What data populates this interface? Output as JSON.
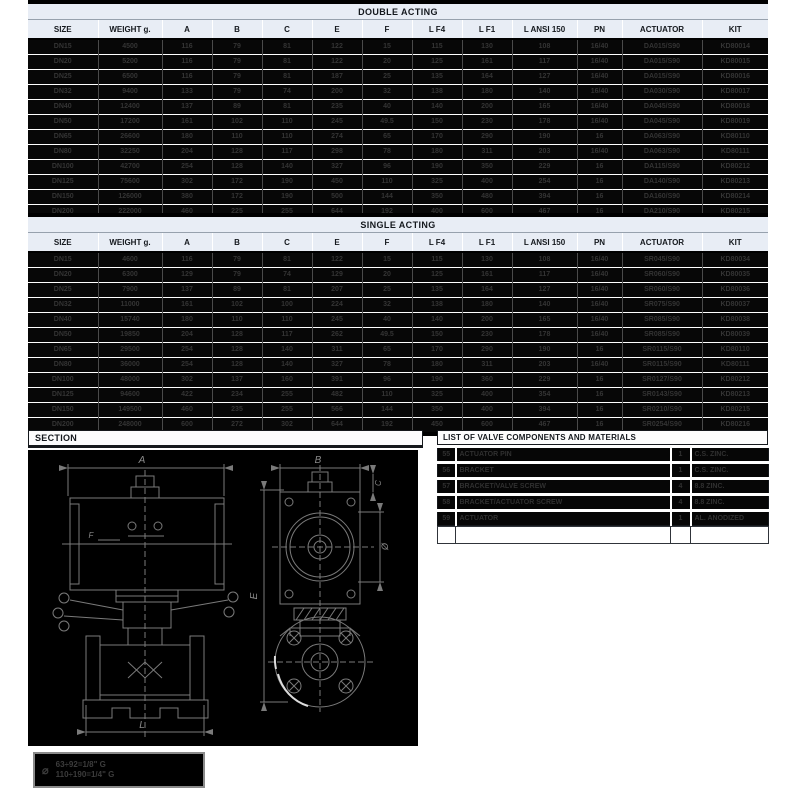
{
  "tables": {
    "columns": [
      "SIZE",
      "WEIGHT g.",
      "A",
      "B",
      "C",
      "E",
      "F",
      "L F4",
      "L F1",
      "L ANSI 150",
      "PN",
      "ACTUATOR",
      "KIT"
    ],
    "double_acting": {
      "title": "DOUBLE ACTING",
      "rows": [
        [
          "DN15",
          "4500",
          "116",
          "79",
          "81",
          "122",
          "15",
          "115",
          "130",
          "108",
          "16/40",
          "DA015/S90",
          "KD80014"
        ],
        [
          "DN20",
          "5200",
          "116",
          "79",
          "81",
          "122",
          "20",
          "125",
          "161",
          "117",
          "16/40",
          "DA015/S90",
          "KD80015"
        ],
        [
          "DN25",
          "6500",
          "116",
          "79",
          "81",
          "187",
          "25",
          "135",
          "164",
          "127",
          "16/40",
          "DA015/S90",
          "KD80016"
        ],
        [
          "DN32",
          "9400",
          "133",
          "79",
          "74",
          "200",
          "32",
          "138",
          "180",
          "140",
          "16/40",
          "DA030/S90",
          "KD80017"
        ],
        [
          "DN40",
          "12400",
          "137",
          "89",
          "81",
          "235",
          "40",
          "140",
          "200",
          "165",
          "16/40",
          "DA045/S90",
          "KD80018"
        ],
        [
          "DN50",
          "17200",
          "161",
          "102",
          "110",
          "245",
          "49.5",
          "150",
          "230",
          "178",
          "16/40",
          "DA045/S90",
          "KD80019"
        ],
        [
          "DN65",
          "26600",
          "180",
          "110",
          "110",
          "274",
          "65",
          "170",
          "290",
          "190",
          "16",
          "DA063/S90",
          "KD80110"
        ],
        [
          "DN80",
          "32250",
          "204",
          "128",
          "117",
          "298",
          "78",
          "180",
          "311",
          "203",
          "16/40",
          "DA063/S90",
          "KD80111"
        ],
        [
          "DN100",
          "42700",
          "254",
          "128",
          "140",
          "327",
          "96",
          "190",
          "350",
          "229",
          "16",
          "DA115/S90",
          "KD80212"
        ],
        [
          "DN125",
          "75600",
          "302",
          "172",
          "190",
          "450",
          "110",
          "325",
          "400",
          "254",
          "16",
          "DA140/S90",
          "KD80213"
        ],
        [
          "DN150",
          "126000",
          "380",
          "172",
          "190",
          "500",
          "144",
          "350",
          "480",
          "394",
          "16",
          "DA160/S90",
          "KD80214"
        ],
        [
          "DN200",
          "222000",
          "460",
          "225",
          "255",
          "644",
          "192",
          "400",
          "600",
          "467",
          "16",
          "DA210/S90",
          "KD80215"
        ]
      ]
    },
    "single_acting": {
      "title": "SINGLE ACTING",
      "rows": [
        [
          "DN15",
          "4600",
          "116",
          "79",
          "81",
          "122",
          "15",
          "115",
          "130",
          "108",
          "16/40",
          "SR045/S90",
          "KD80034"
        ],
        [
          "DN20",
          "6300",
          "129",
          "79",
          "74",
          "129",
          "20",
          "125",
          "161",
          "117",
          "16/40",
          "SR060/S90",
          "KD80035"
        ],
        [
          "DN25",
          "7900",
          "137",
          "89",
          "81",
          "207",
          "25",
          "135",
          "164",
          "127",
          "16/40",
          "SR060/S90",
          "KD80036"
        ],
        [
          "DN32",
          "11000",
          "161",
          "102",
          "100",
          "224",
          "32",
          "138",
          "180",
          "140",
          "16/40",
          "SR075/S90",
          "KD80037"
        ],
        [
          "DN40",
          "15740",
          "180",
          "110",
          "110",
          "245",
          "40",
          "140",
          "200",
          "165",
          "16/40",
          "SR085/S90",
          "KD80038"
        ],
        [
          "DN50",
          "19850",
          "204",
          "128",
          "117",
          "262",
          "49.5",
          "150",
          "230",
          "178",
          "16/40",
          "SR085/S90",
          "KD80039"
        ],
        [
          "DN65",
          "29500",
          "254",
          "128",
          "140",
          "311",
          "65",
          "170",
          "290",
          "190",
          "16",
          "SR0115/S90",
          "KD80110"
        ],
        [
          "DN80",
          "36000",
          "254",
          "128",
          "140",
          "327",
          "78",
          "180",
          "311",
          "203",
          "16/40",
          "SR0115/S90",
          "KD80111"
        ],
        [
          "DN100",
          "48000",
          "302",
          "137",
          "160",
          "391",
          "96",
          "190",
          "360",
          "229",
          "16",
          "SR0127/S90",
          "KD80212"
        ],
        [
          "DN125",
          "94600",
          "422",
          "234",
          "255",
          "482",
          "110",
          "325",
          "400",
          "354",
          "16",
          "SR0143/S90",
          "KD80213"
        ],
        [
          "DN150",
          "149500",
          "460",
          "235",
          "255",
          "566",
          "144",
          "350",
          "400",
          "394",
          "16",
          "SR0210/S90",
          "KD80215"
        ],
        [
          "DN200",
          "248000",
          "600",
          "272",
          "302",
          "644",
          "192",
          "450",
          "600",
          "467",
          "16",
          "SR0254/S90",
          "KD80216"
        ]
      ]
    }
  },
  "section": {
    "title": "SECTION",
    "labels": {
      "a": "A",
      "b": "B",
      "e": "E",
      "l": "L",
      "c": "C",
      "f": "F",
      "diameter": "Ø"
    },
    "note": {
      "symbol": "⌀",
      "lines": [
        "63÷92=1/8\" G",
        "110÷190=1/4\" G"
      ]
    }
  },
  "components": {
    "title": "LIST OF VALVE COMPONENTS AND MATERIALS",
    "rows": [
      [
        "55",
        "ACTUATOR PIN",
        "1",
        "C.S. ZINC."
      ],
      [
        "56",
        "BRACKET",
        "1",
        "C.S. ZINC."
      ],
      [
        "57",
        "BRACKET/VALVE SCREW",
        "4",
        "8.8 ZINC."
      ],
      [
        "58",
        "BRACKET/ACTUATOR SCREW",
        "4",
        "8.8 ZINC."
      ],
      [
        "59",
        "ACTUATOR",
        "1",
        "AL. ANODIZED"
      ]
    ]
  },
  "colors": {
    "header_bg": "#e8edf5",
    "row_bg": "#070707",
    "row_text": "#343434",
    "line": "#7a7a7a"
  }
}
